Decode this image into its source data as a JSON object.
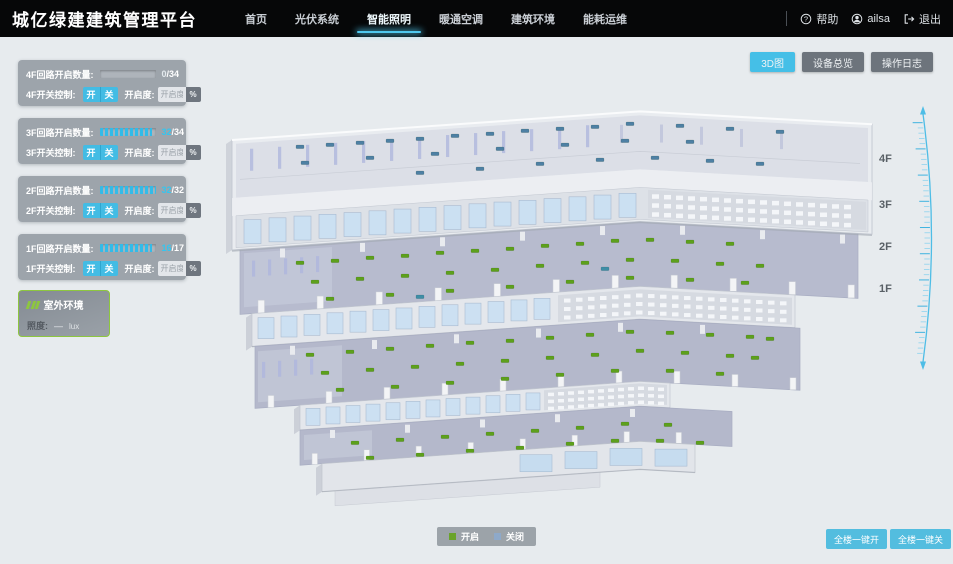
{
  "header": {
    "title": "城亿绿建建筑管理平台",
    "menu": [
      {
        "label": "首页"
      },
      {
        "label": "光伏系统"
      },
      {
        "label": "智能照明"
      },
      {
        "label": "暖通空调"
      },
      {
        "label": "建筑环境"
      },
      {
        "label": "能耗运维"
      }
    ],
    "active_menu_index": 2,
    "help": "帮助",
    "user": "ailsa",
    "logout": "退出"
  },
  "view_buttons": [
    {
      "label": "3D图",
      "active": true
    },
    {
      "label": "设备总览",
      "active": false
    },
    {
      "label": "操作日志",
      "active": false
    }
  ],
  "floor_panels": [
    {
      "floor": "4F",
      "circuit_label": "4F回路开启数量:",
      "current": "0",
      "total_text": "/34",
      "current_color": "#e4eaee",
      "progress": "0%",
      "switch_label": "4F开关控制:",
      "on_label": "开",
      "off_label": "关",
      "dim_label": "开启度:",
      "dim_placeholder": "开启度",
      "percent_label": "%"
    },
    {
      "floor": "3F",
      "circuit_label": "3F回路开启数量:",
      "current": "32",
      "total_text": "/34",
      "current_color": "#35c5ef",
      "progress": "94%",
      "switch_label": "3F开关控制:",
      "on_label": "开",
      "off_label": "关",
      "dim_label": "开启度:",
      "dim_placeholder": "开启度",
      "percent_label": "%"
    },
    {
      "floor": "2F",
      "circuit_label": "2F回路开启数量:",
      "current": "32",
      "total_text": "/32",
      "current_color": "#35c5ef",
      "progress": "100%",
      "switch_label": "2F开关控制:",
      "on_label": "开",
      "off_label": "关",
      "dim_label": "开启度:",
      "dim_placeholder": "开启度",
      "percent_label": "%"
    },
    {
      "floor": "1F",
      "circuit_label": "1F回路开启数量:",
      "current": "16",
      "total_text": "/17",
      "current_color": "#35c5ef",
      "progress": "94%",
      "switch_label": "1F开关控制:",
      "on_label": "开",
      "off_label": "关",
      "dim_label": "开启度:",
      "dim_placeholder": "开启度",
      "percent_label": "%"
    }
  ],
  "outdoor": {
    "title": "室外环境",
    "illuminance_label": "照度:",
    "value": "—",
    "unit": "lux"
  },
  "floor_scale": [
    "4F",
    "3F",
    "2F",
    "1F"
  ],
  "legend": [
    {
      "label": "开启",
      "color": "#6aa32a"
    },
    {
      "label": "关闭",
      "color": "#8ea9c9"
    }
  ],
  "bulk_buttons": [
    "全楼一键开",
    "全楼一键关"
  ],
  "colors": {
    "accent": "#45bfe7",
    "nav_underline": "#4fc8ee",
    "panel_gray": "#979ea6",
    "outdoor_green": "#8dc63f"
  },
  "building": {
    "marker_on_color": "#5da01c",
    "marker_off_color": "#4e80a4",
    "marker_teal_color": "#3f8ea6",
    "floors": [
      {
        "id": "4F",
        "state": "off",
        "markers": [
          [
            300,
            147
          ],
          [
            330,
            145
          ],
          [
            360,
            143
          ],
          [
            390,
            141
          ],
          [
            420,
            139
          ],
          [
            455,
            136
          ],
          [
            490,
            134
          ],
          [
            525,
            131
          ],
          [
            560,
            129
          ],
          [
            595,
            127
          ],
          [
            630,
            124
          ],
          [
            680,
            126
          ],
          [
            730,
            129
          ],
          [
            780,
            132
          ],
          [
            305,
            163
          ],
          [
            370,
            158
          ],
          [
            435,
            154
          ],
          [
            500,
            149
          ],
          [
            565,
            145
          ],
          [
            625,
            141
          ],
          [
            690,
            142
          ],
          [
            420,
            173
          ],
          [
            480,
            169
          ],
          [
            540,
            164
          ],
          [
            600,
            160
          ],
          [
            655,
            158
          ],
          [
            710,
            161
          ],
          [
            760,
            164
          ]
        ]
      },
      {
        "id": "3F",
        "state": "on",
        "markers": [
          [
            300,
            263
          ],
          [
            335,
            261
          ],
          [
            370,
            258
          ],
          [
            405,
            256
          ],
          [
            440,
            253
          ],
          [
            475,
            251
          ],
          [
            510,
            249
          ],
          [
            545,
            246
          ],
          [
            580,
            244
          ],
          [
            615,
            241
          ],
          [
            650,
            240
          ],
          [
            690,
            242
          ],
          [
            730,
            244
          ],
          [
            315,
            282
          ],
          [
            360,
            279
          ],
          [
            405,
            276
          ],
          [
            450,
            273
          ],
          [
            495,
            270
          ],
          [
            540,
            266
          ],
          [
            585,
            263
          ],
          [
            630,
            260
          ],
          [
            675,
            261
          ],
          [
            720,
            264
          ],
          [
            760,
            266
          ],
          [
            330,
            299
          ],
          [
            390,
            295
          ],
          [
            450,
            291
          ],
          [
            510,
            287
          ],
          [
            570,
            282
          ],
          [
            630,
            278
          ],
          [
            690,
            280
          ],
          [
            745,
            283
          ]
        ],
        "extra_off": [
          [
            420,
            297
          ],
          [
            605,
            269
          ]
        ]
      },
      {
        "id": "2F",
        "state": "on",
        "markers": [
          [
            310,
            355
          ],
          [
            350,
            352
          ],
          [
            390,
            349
          ],
          [
            430,
            346
          ],
          [
            470,
            343
          ],
          [
            510,
            341
          ],
          [
            550,
            338
          ],
          [
            590,
            335
          ],
          [
            630,
            332
          ],
          [
            670,
            333
          ],
          [
            710,
            335
          ],
          [
            750,
            337
          ],
          [
            325,
            373
          ],
          [
            370,
            370
          ],
          [
            415,
            367
          ],
          [
            460,
            364
          ],
          [
            505,
            361
          ],
          [
            550,
            358
          ],
          [
            595,
            355
          ],
          [
            640,
            351
          ],
          [
            685,
            353
          ],
          [
            730,
            356
          ],
          [
            340,
            390
          ],
          [
            395,
            387
          ],
          [
            450,
            383
          ],
          [
            505,
            379
          ],
          [
            560,
            375
          ],
          [
            615,
            371
          ],
          [
            670,
            371
          ],
          [
            720,
            374
          ],
          [
            770,
            339
          ],
          [
            755,
            358
          ]
        ]
      },
      {
        "id": "1F",
        "state": "on",
        "markers": [
          [
            355,
            443
          ],
          [
            400,
            440
          ],
          [
            445,
            437
          ],
          [
            490,
            434
          ],
          [
            535,
            431
          ],
          [
            580,
            428
          ],
          [
            625,
            424
          ],
          [
            668,
            425
          ],
          [
            370,
            458
          ],
          [
            420,
            455
          ],
          [
            470,
            451
          ],
          [
            520,
            448
          ],
          [
            570,
            444
          ],
          [
            615,
            441
          ],
          [
            660,
            441
          ],
          [
            700,
            443
          ]
        ]
      }
    ]
  }
}
